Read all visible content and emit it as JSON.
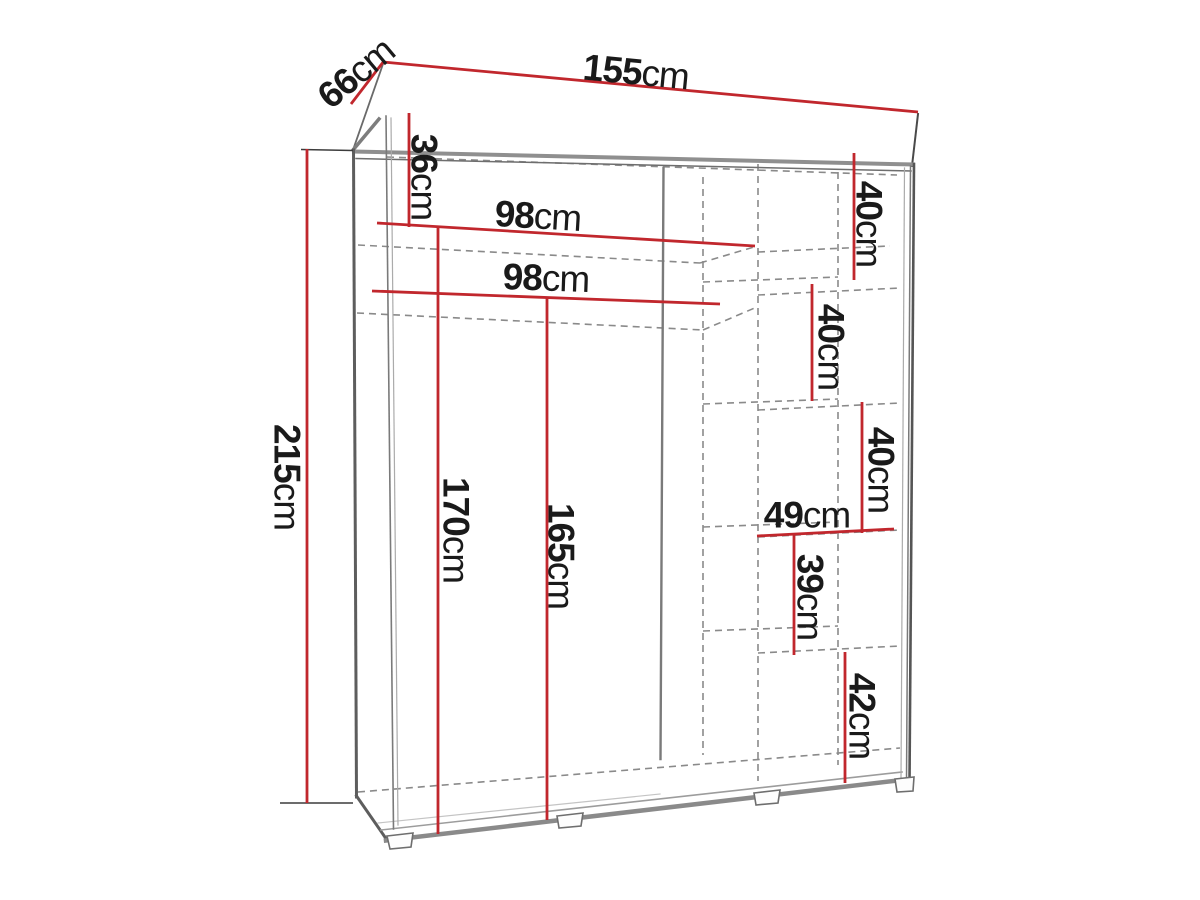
{
  "diagram": {
    "kind": "wardrobe-dimension-drawing",
    "unit": "cm",
    "colors": {
      "dimension_line": "#c1272d",
      "outline_dark": "#565656",
      "outline_light": "#8f8f8f",
      "hidden_edge": "#8a8a8a",
      "label_text": "#1a1a1a",
      "background": "#ffffff"
    },
    "overall": {
      "width_cm": 155,
      "depth_cm": 66,
      "height_cm": 215
    },
    "labels": {
      "d155": {
        "value": "155",
        "unit": "cm",
        "position": "top-width"
      },
      "d66": {
        "value": "66",
        "unit": "cm",
        "position": "top-left-depth"
      },
      "d36": {
        "value": "36",
        "unit": "cm",
        "position": "upper-left-inner"
      },
      "d98a": {
        "value": "98",
        "unit": "cm",
        "position": "upper-inner-width"
      },
      "d98b": {
        "value": "98",
        "unit": "cm",
        "position": "lower-inner-width"
      },
      "d215": {
        "value": "215",
        "unit": "cm",
        "position": "left-overall-height"
      },
      "d170": {
        "value": "170",
        "unit": "cm",
        "position": "left-inner-height"
      },
      "d165": {
        "value": "165",
        "unit": "cm",
        "position": "middle-inner-height"
      },
      "d40a": {
        "value": "40",
        "unit": "cm",
        "position": "right-shelf-gap-1"
      },
      "d40b": {
        "value": "40",
        "unit": "cm",
        "position": "right-shelf-gap-2"
      },
      "d40c": {
        "value": "40",
        "unit": "cm",
        "position": "right-shelf-gap-3"
      },
      "d49": {
        "value": "49",
        "unit": "cm",
        "position": "right-shelf-width"
      },
      "d39": {
        "value": "39",
        "unit": "cm",
        "position": "right-shelf-gap-4"
      },
      "d42": {
        "value": "42",
        "unit": "cm",
        "position": "right-shelf-gap-5"
      }
    }
  }
}
